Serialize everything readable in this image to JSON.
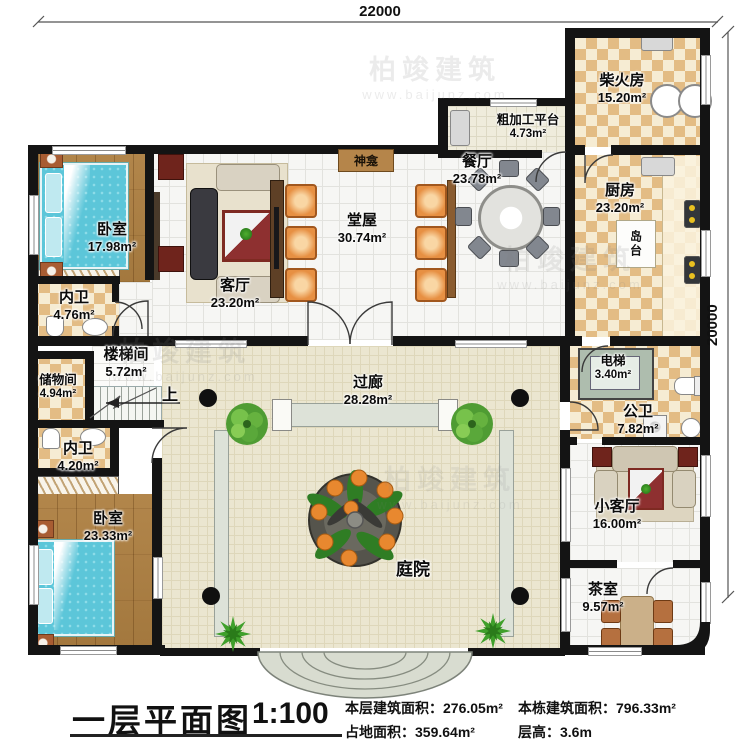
{
  "dimensions": {
    "width": "22000",
    "height": "20000"
  },
  "rooms": {
    "bedroom1": {
      "name": "卧室",
      "area": "17.98m²"
    },
    "bath1": {
      "name": "内卫",
      "area": "4.76m²"
    },
    "living": {
      "name": "客厅",
      "area": "23.20m²"
    },
    "hall": {
      "name": "堂屋",
      "area": "30.74m²"
    },
    "dining": {
      "name": "餐厅",
      "area": "23.78m²"
    },
    "platform": {
      "name": "粗加工平台",
      "area": "4.73m²"
    },
    "firewood": {
      "name": "柴火房",
      "area": "15.20m²"
    },
    "kitchen": {
      "name": "厨房",
      "area": "23.20m²"
    },
    "stair": {
      "name": "楼梯间",
      "area": "5.72m²"
    },
    "storage": {
      "name": "储物间",
      "area": "4.94m²"
    },
    "bath2": {
      "name": "内卫",
      "area": "4.20m²"
    },
    "bedroom2": {
      "name": "卧室",
      "area": "23.33m²"
    },
    "corridor": {
      "name": "过廊",
      "area": "28.28m²"
    },
    "elevator": {
      "name": "电梯",
      "area": "3.40m²"
    },
    "publicbath": {
      "name": "公卫",
      "area": "7.82m²"
    },
    "smallliving": {
      "name": "小客厅",
      "area": "16.00m²"
    },
    "tearoom": {
      "name": "茶室",
      "area": "9.57m²"
    },
    "courtyard": {
      "name": "庭院"
    }
  },
  "annotations": {
    "shrine": "神龛",
    "island": "岛台",
    "up": "上"
  },
  "title_block": {
    "title": "一层平面图",
    "scale": "1:100",
    "floor_area": "本层建筑面积：276.05m²",
    "building_area": "本栋建筑面积：796.33m²",
    "land_area": "占地面积：359.64m²",
    "floor_height": "层高：3.6m"
  },
  "watermark": {
    "brand": "柏竣建筑",
    "url": "www.baijunz.com"
  }
}
